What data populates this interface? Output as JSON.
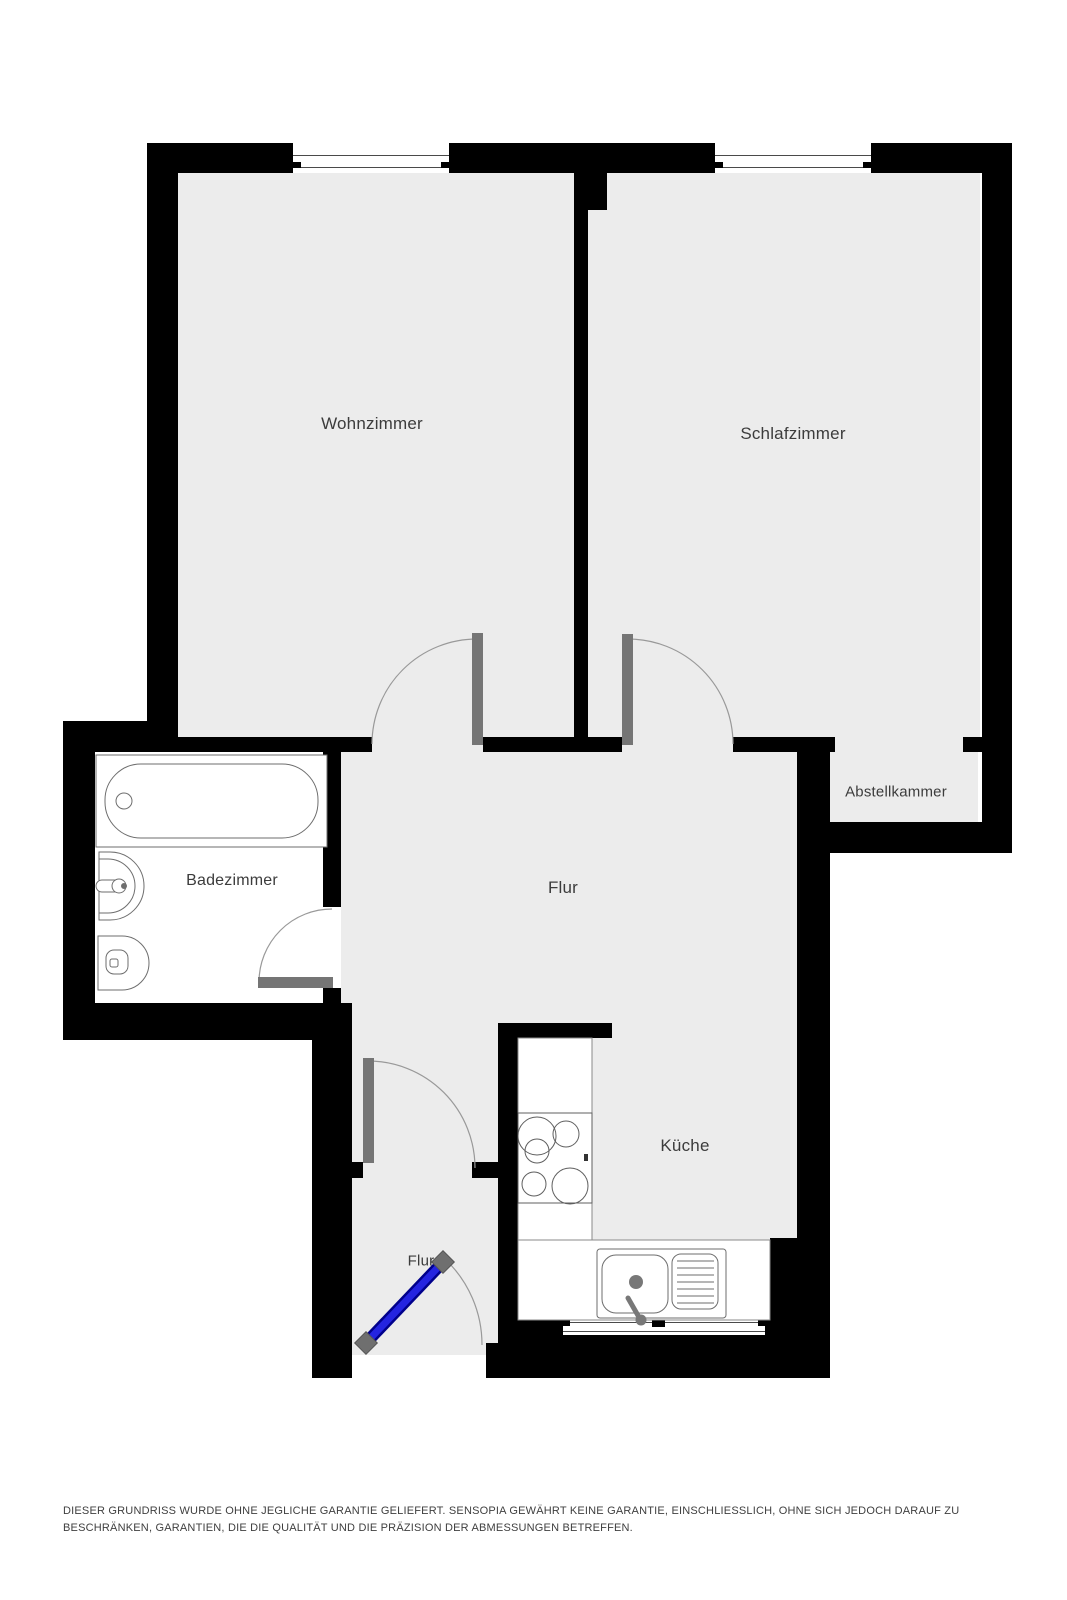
{
  "floorplan": {
    "rooms": [
      {
        "id": "wohnzimmer",
        "label": "Wohnzimmer"
      },
      {
        "id": "schlafzimmer",
        "label": "Schlafzimmer"
      },
      {
        "id": "abstellkammer",
        "label": "Abstellkammer"
      },
      {
        "id": "badezimmer",
        "label": "Badezimmer"
      },
      {
        "id": "flur",
        "label": "Flur"
      },
      {
        "id": "kueche",
        "label": "Küche"
      },
      {
        "id": "flur-eingang",
        "label": "Flur"
      }
    ],
    "fixtures": [
      "bathtub",
      "washbasin",
      "toilet",
      "stove",
      "kitchen-sink",
      "drainboard",
      "counter"
    ],
    "colors": {
      "wall": "#000000",
      "floor": "#ececec",
      "bathroom_floor": "#ffffff",
      "door_leaf": "#757575",
      "entrance_door": "#2424e0",
      "fixture_outline": "#6e6e6e"
    }
  },
  "disclaimer": "DIESER GRUNDRISS WURDE OHNE JEGLICHE GARANTIE GELIEFERT. SENSOPIA GEWÄHRT KEINE GARANTIE, EINSCHLIESSLICH, OHNE SICH JEDOCH DARAUF ZU BESCHRÄNKEN, GARANTIEN, DIE DIE QUALITÄT UND DIE PRÄZISION DER ABMESSUNGEN BETREFFEN."
}
